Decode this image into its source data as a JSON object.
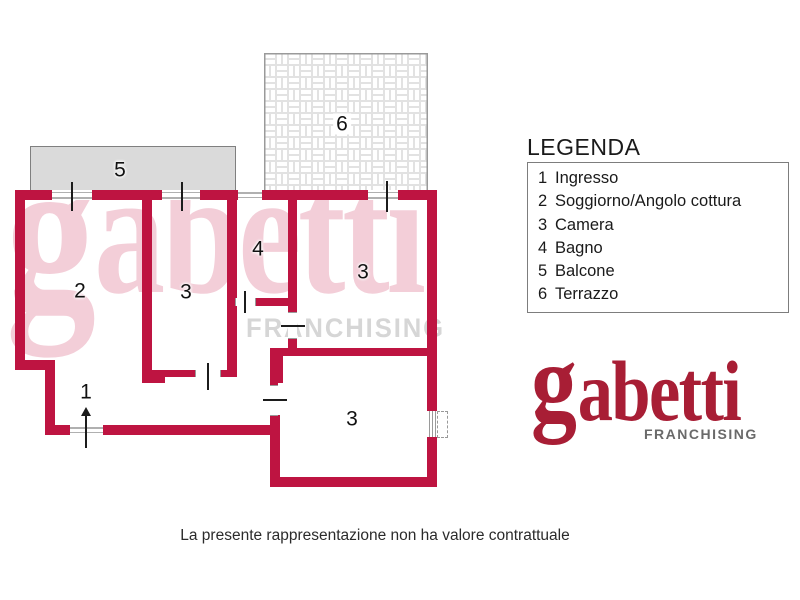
{
  "colors": {
    "wall_red": "#be1441",
    "logo_red": "#a81e35",
    "watermark_pink": "#f3ced8",
    "watermark_gray": "#d6d6d6",
    "balcony_fill": "#dadada",
    "balcony_border": "#7f7f7f",
    "terrace_border": "#9a9a9a",
    "label_text": "#111111",
    "body_text": "#2b2b2b",
    "franchising_gray": "#6a6a6a"
  },
  "plan": {
    "room_labels": {
      "balcone": "5",
      "terrazzo": "6",
      "soggiorno": "2",
      "camera_centro": "3",
      "bagno": "4",
      "camera_alto_dx": "3",
      "ingresso": "1",
      "camera_basso_dx": "3"
    },
    "watermark": {
      "word_g": "g",
      "word_rest": "abetti",
      "sub": "FRANCHISING"
    }
  },
  "legend": {
    "title": "LEGENDA",
    "items": [
      {
        "n": "1",
        "label": "Ingresso"
      },
      {
        "n": "2",
        "label": "Soggiorno/Angolo cottura"
      },
      {
        "n": "3",
        "label": "Camera"
      },
      {
        "n": "4",
        "label": "Bagno"
      },
      {
        "n": "5",
        "label": "Balcone"
      },
      {
        "n": "6",
        "label": "Terrazzo"
      }
    ]
  },
  "logo": {
    "word_g": "g",
    "word_rest": "abetti",
    "sub": "FRANCHISING"
  },
  "footer": {
    "disclaimer": "La presente rappresentazione non ha valore contrattuale"
  }
}
